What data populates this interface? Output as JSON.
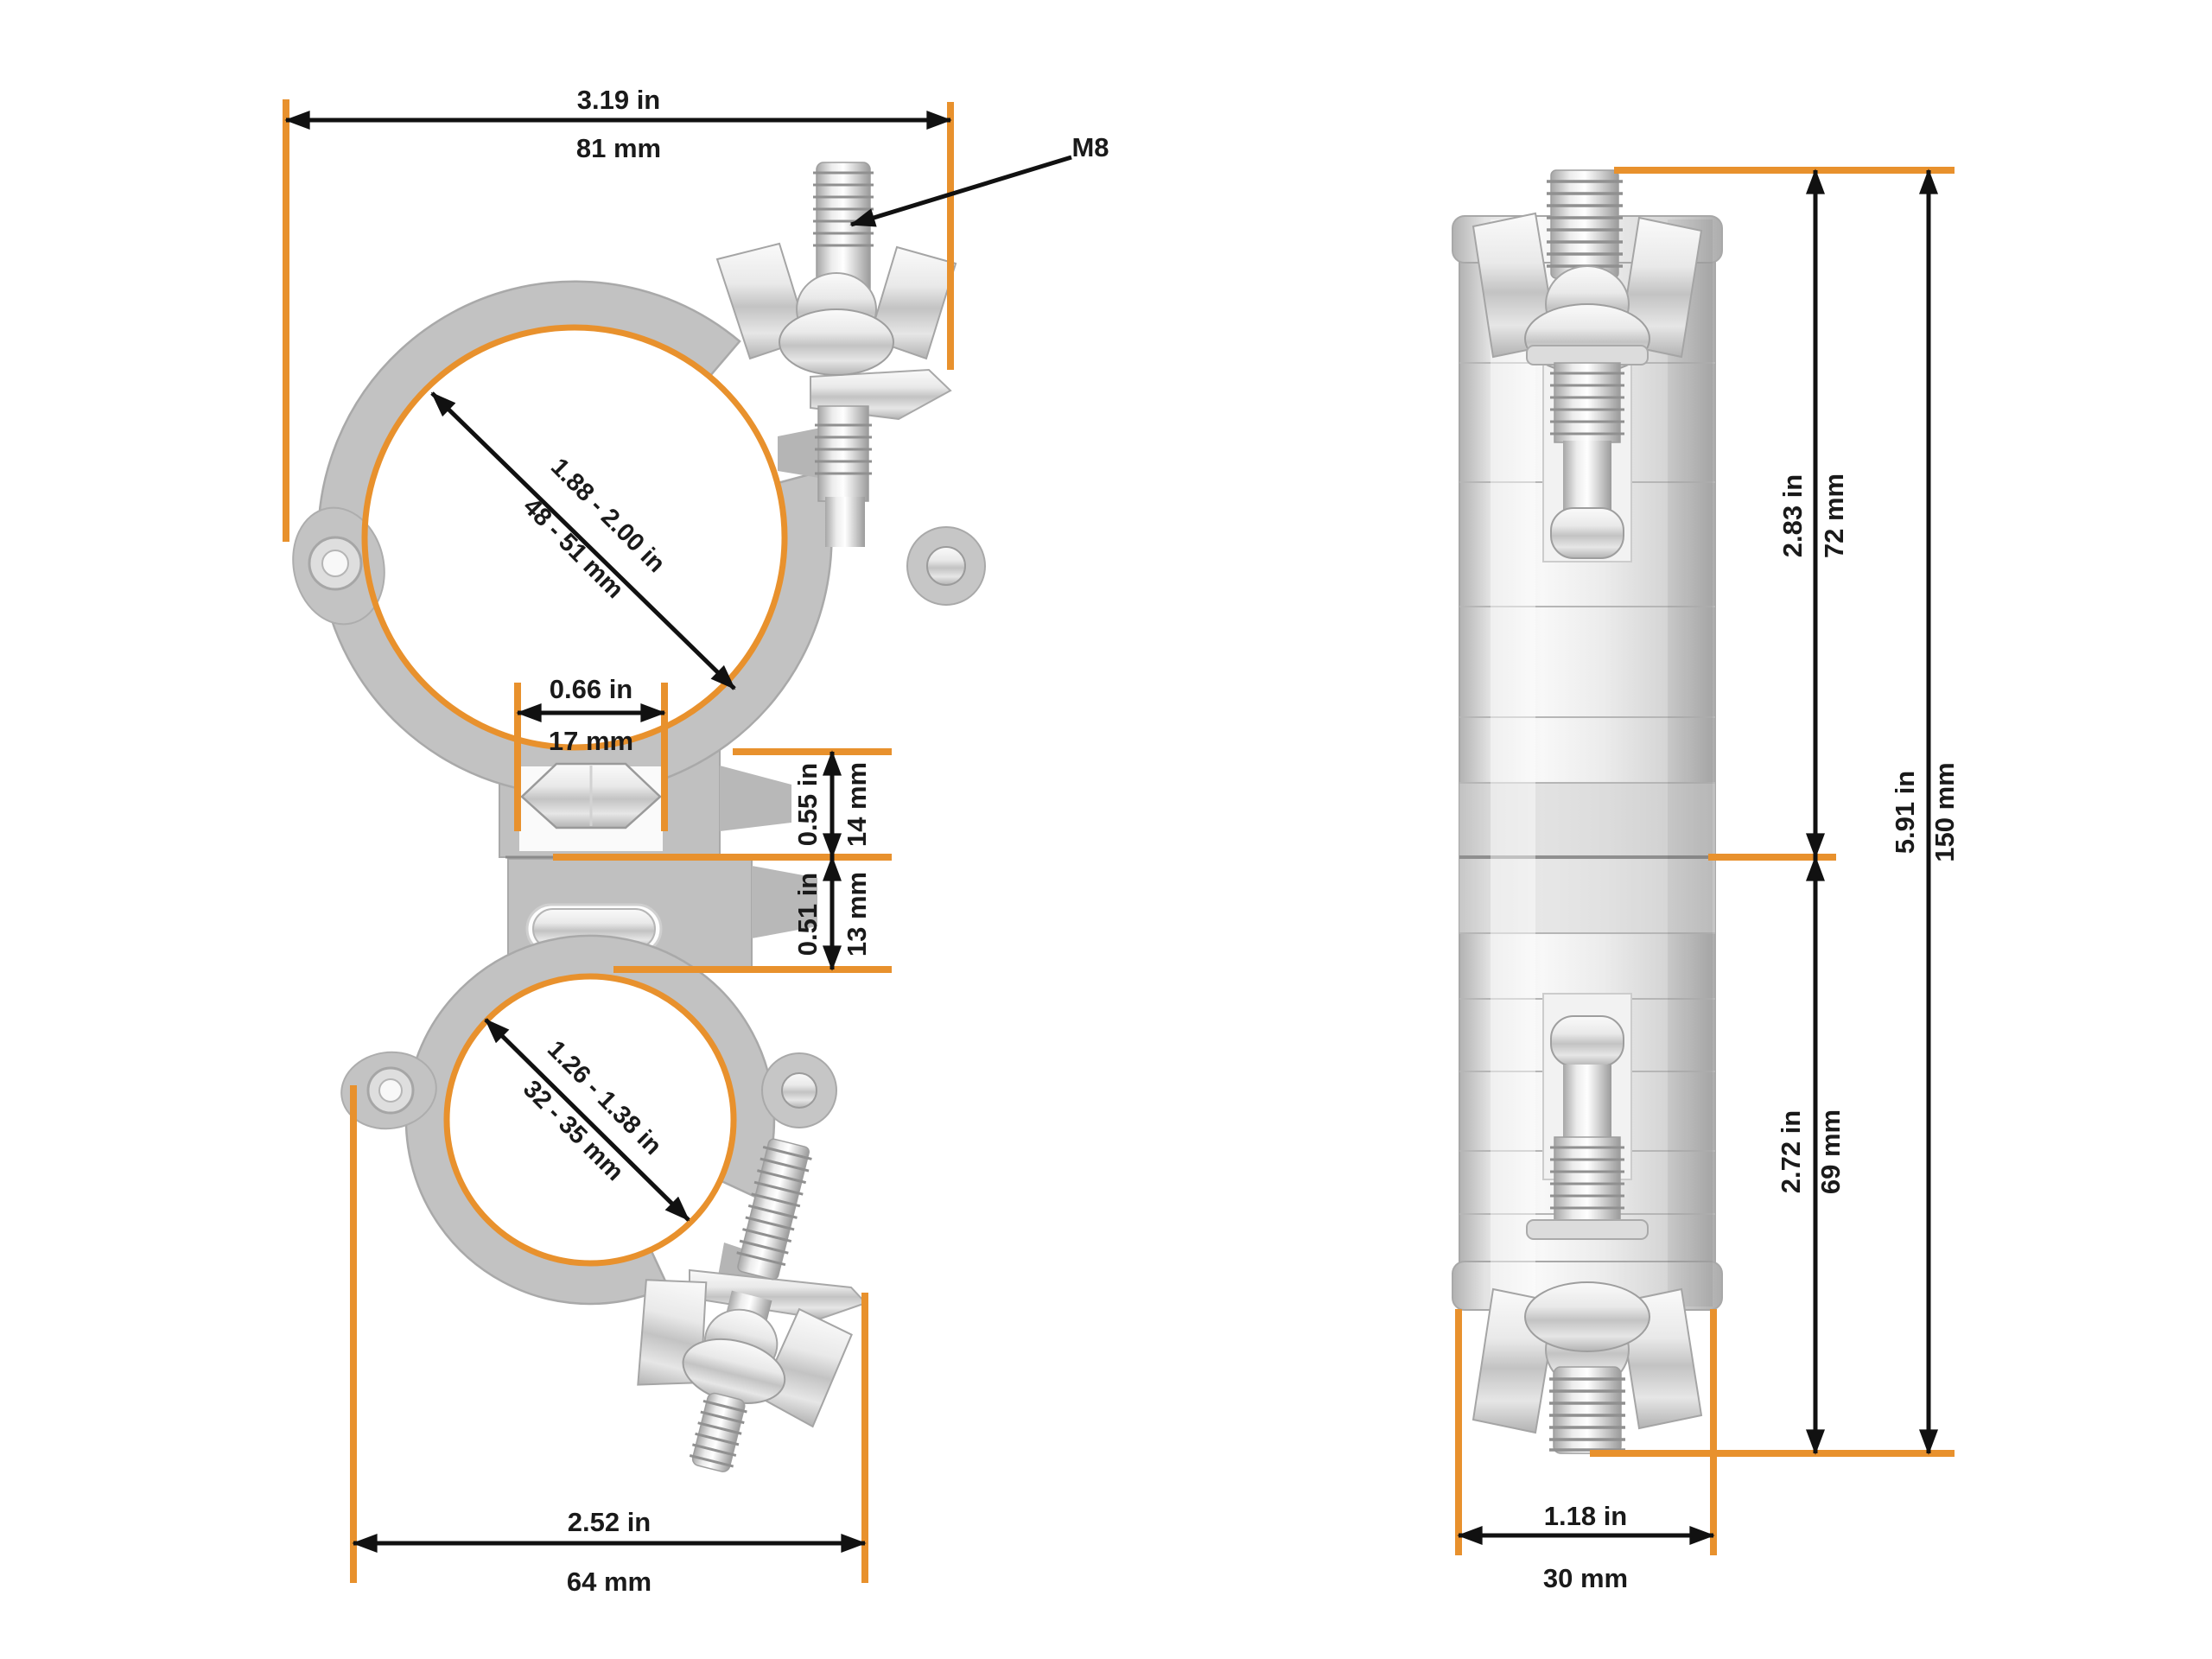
{
  "colors": {
    "accent": "#E8912D",
    "line": "#111111",
    "text": "#1a1a1a"
  },
  "front_view": {
    "top_width": {
      "inches": "3.19 in",
      "metric": "81 mm"
    },
    "bolt_thread_label": "M8",
    "top_pipe_range": {
      "inches": "1.88 - 2.00 in",
      "metric": "48 - 51 mm"
    },
    "hex_nut_width": {
      "inches": "0.66 in",
      "metric": "17 mm"
    },
    "upper_swivel_height": {
      "inches": "0.55 in",
      "metric": "14 mm"
    },
    "lower_swivel_height": {
      "inches": "0.51 in",
      "metric": "13 mm"
    },
    "bottom_pipe_range": {
      "inches": "1.26 - 1.38 in",
      "metric": "32 - 35 mm"
    },
    "bottom_width": {
      "inches": "2.52 in",
      "metric": "64 mm"
    }
  },
  "side_view": {
    "upper_section_height": {
      "inches": "2.83 in",
      "metric": "72 mm"
    },
    "overall_height": {
      "inches": "5.91 in",
      "metric": "150 mm"
    },
    "lower_section_height": {
      "inches": "2.72 in",
      "metric": "69 mm"
    },
    "body_width": {
      "inches": "1.18 in",
      "metric": "30 mm"
    }
  }
}
